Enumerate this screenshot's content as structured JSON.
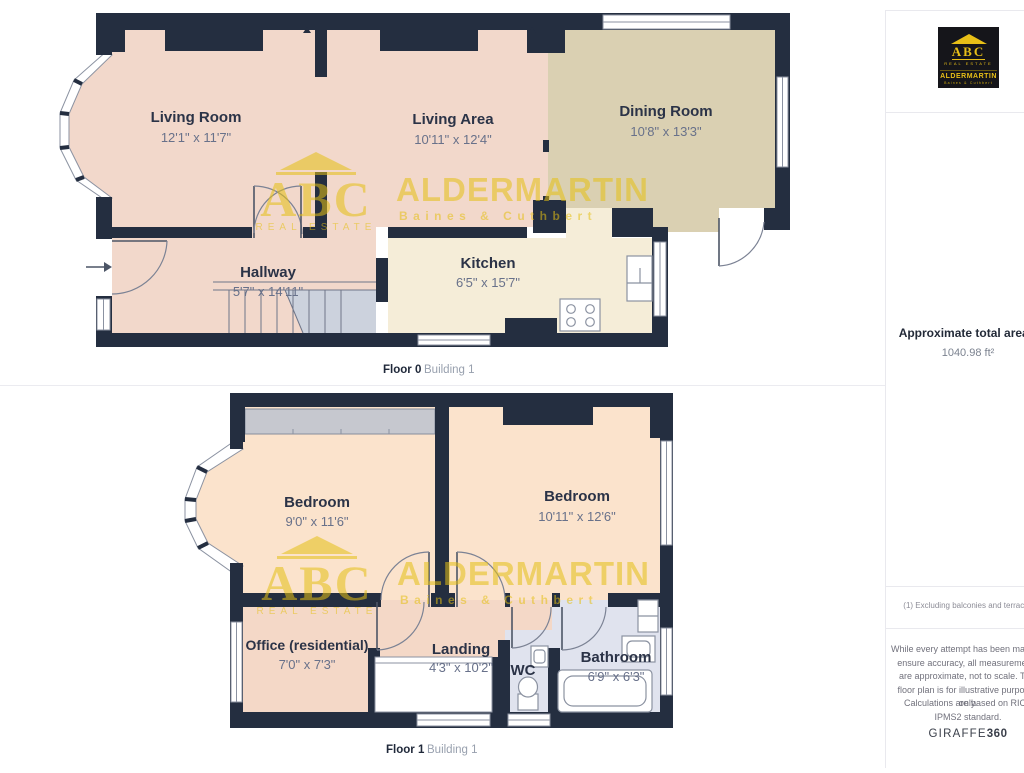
{
  "watermark": {
    "abc": "ABC",
    "tagline": "REAL ESTATE",
    "name": "ALDERMARTIN",
    "sub": "Baines & Cuthbert"
  },
  "floor0": {
    "caption": {
      "floor": "Floor 0",
      "building": "Building 1"
    },
    "rooms": {
      "living_room": {
        "name": "Living Room",
        "dims": "12'1\" x 11'7\""
      },
      "living_area": {
        "name": "Living Area",
        "dims": "10'11\" x 12'4\""
      },
      "dining_room": {
        "name": "Dining Room",
        "dims": "10'8\" x 13'3\""
      },
      "hallway": {
        "name": "Hallway",
        "dims": "5'7\" x 14'11\""
      },
      "kitchen": {
        "name": "Kitchen",
        "dims": "6'5\" x 15'7\""
      }
    }
  },
  "floor1": {
    "caption": {
      "floor": "Floor 1",
      "building": "Building 1"
    },
    "rooms": {
      "bedroom1": {
        "name": "Bedroom",
        "dims": "9'0\" x 11'6\""
      },
      "bedroom2": {
        "name": "Bedroom",
        "dims": "10'11\" x 12'6\""
      },
      "office": {
        "name": "Office (residential)",
        "dims": "7'0\" x 7'3\""
      },
      "landing": {
        "name": "Landing",
        "dims": "4'3\" x 10'2\""
      },
      "wc": {
        "name": "WC"
      },
      "bathroom": {
        "name": "Bathroom",
        "dims": "6'9\" x 6'3\""
      }
    }
  },
  "sidebar": {
    "logo": {
      "abc": "ABC",
      "tagline": "REAL ESTATE",
      "name": "ALDERMARTIN",
      "sub": "Baines & Cuthbert"
    },
    "area_title": "Approximate total area",
    "area_footnote_marker": "(1)",
    "area_value": "1040.98 ft²",
    "footnote": "(1) Excluding balconies and terraces",
    "disclaimer": "While every attempt has been made to ensure accuracy, all measurements are approximate, not to scale. This floor plan is for illustrative purposes only.",
    "standard": "Calculations are based on RICS IPMS2 standard.",
    "brand": {
      "name": "GIRAFFE",
      "suffix": "360"
    }
  },
  "colors": {
    "wall": "#242e40",
    "watermark_yellow": "#e5c013",
    "logo_bg": "#15151a",
    "room_pink": "#f2d8cb",
    "room_tan": "#dad0b2",
    "room_cream": "#f5edd8",
    "room_peach": "#fbe3cc",
    "room_bath": "#e0e3ee"
  }
}
